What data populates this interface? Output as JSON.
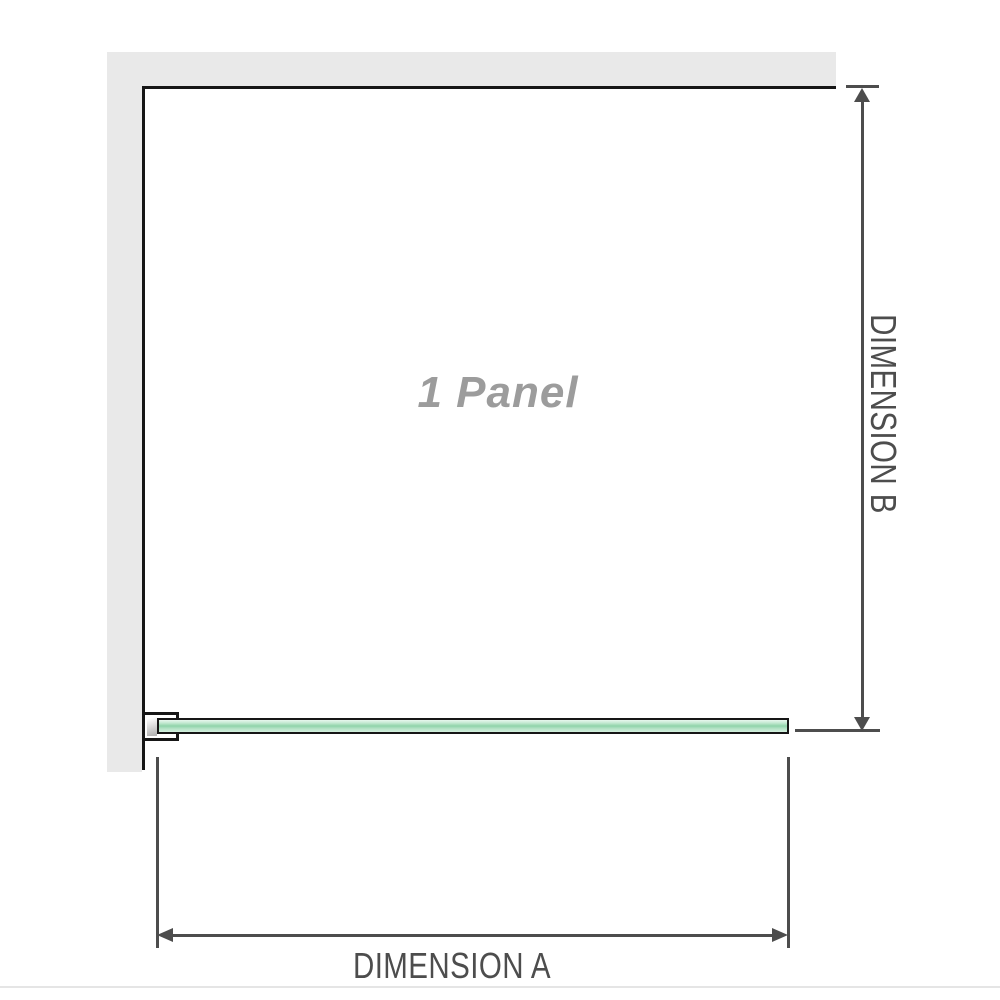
{
  "diagram": {
    "panel_label": "1 Panel",
    "dimensions": {
      "a_label": "DIMENSION A",
      "b_label": "DIMENSION B"
    }
  },
  "colors": {
    "wall": "#e9e9e9",
    "outline": "#161616",
    "glass-light": "#c3e9d1",
    "glass-mid": "#8fd3aa",
    "dim": "#4d4d4d",
    "panel-label": "#9c9c9c",
    "baseline": "#e5e5e5"
  }
}
